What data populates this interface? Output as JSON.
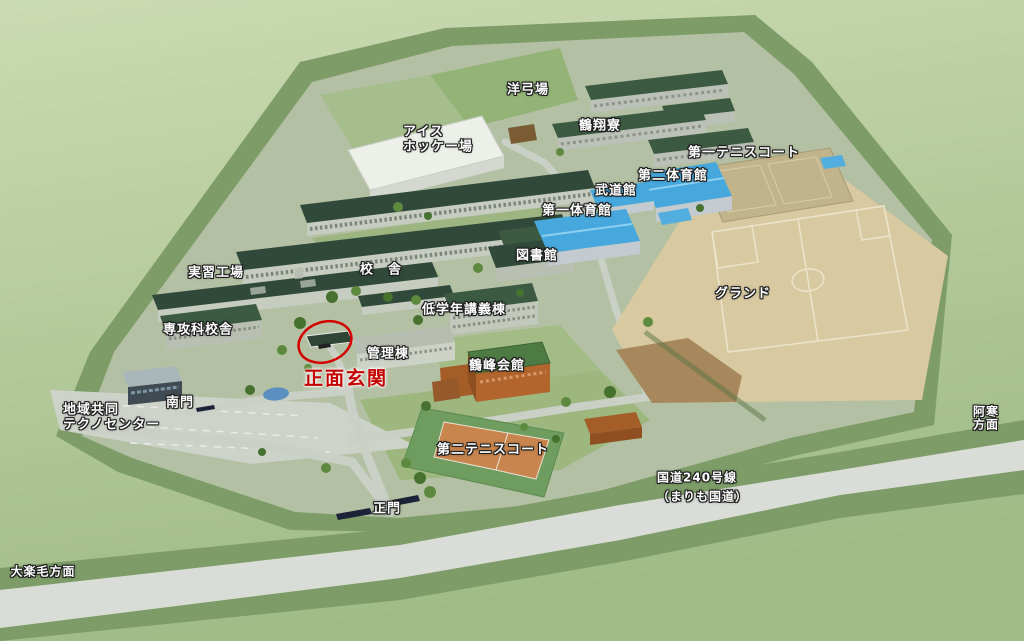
{
  "map": {
    "labels": [
      {
        "id": "youkyujo",
        "text": "洋弓場",
        "x": 528,
        "y": 91
      },
      {
        "id": "kakushoryo",
        "text": "鶴翔寮",
        "x": 600,
        "y": 127
      },
      {
        "id": "ice-hockey-rink",
        "text": "アイス\nホッケー場",
        "x": 403,
        "y": 140,
        "anchor": "left"
      },
      {
        "id": "tennis-court-1",
        "text": "第一テニスコート",
        "x": 744,
        "y": 154
      },
      {
        "id": "gym-2",
        "text": "第二体育館",
        "x": 673,
        "y": 177
      },
      {
        "id": "budokan",
        "text": "武道館",
        "x": 616,
        "y": 192
      },
      {
        "id": "gym-1",
        "text": "第一体育館",
        "x": 577,
        "y": 212
      },
      {
        "id": "library",
        "text": "図書館",
        "x": 537,
        "y": 257
      },
      {
        "id": "school-building",
        "text": "校　舎",
        "x": 381,
        "y": 271
      },
      {
        "id": "practice-factory",
        "text": "実習工場",
        "x": 216,
        "y": 274
      },
      {
        "id": "lower-grade-lecture",
        "text": "低学年講義棟",
        "x": 464,
        "y": 311
      },
      {
        "id": "ground",
        "text": "グランド",
        "x": 743,
        "y": 295
      },
      {
        "id": "advanced-course-bldg",
        "text": "専攻科校舎",
        "x": 198,
        "y": 331
      },
      {
        "id": "admin-building",
        "text": "管理棟",
        "x": 388,
        "y": 355
      },
      {
        "id": "main-entrance",
        "text": "正面玄関",
        "x": 346,
        "y": 379,
        "variant": "entrance"
      },
      {
        "id": "kakuho-kaikan",
        "text": "鶴峰会館",
        "x": 497,
        "y": 367
      },
      {
        "id": "techno-center",
        "text": "地域共同\nテクノセンター",
        "x": 63,
        "y": 418,
        "anchor": "left"
      },
      {
        "id": "south-gate",
        "text": "南門",
        "x": 180,
        "y": 404
      },
      {
        "id": "tennis-court-2",
        "text": "第二テニスコート",
        "x": 493,
        "y": 451
      },
      {
        "id": "main-gate",
        "text": "正門",
        "x": 387,
        "y": 510
      },
      {
        "id": "route-240",
        "text": "国道240号線\n（まりも国道）",
        "x": 657,
        "y": 487,
        "anchor": "left",
        "variant": "road"
      },
      {
        "id": "akan-direction",
        "text": "阿寒方面",
        "x": 986,
        "y": 419,
        "variant": "direction"
      },
      {
        "id": "otanoshike-direction",
        "text": "大楽毛方面",
        "x": 43,
        "y": 572,
        "variant": "direction"
      }
    ],
    "entrance_marker": {
      "x": 325,
      "y": 342,
      "rx": 27,
      "ry": 20,
      "rotation": -18,
      "color": "#d40000"
    },
    "colors": {
      "label_text": "#ffffff",
      "label_outline": "#1c1c1c",
      "entrance_red": "#c40000",
      "outer_terrain": "#b7cc9c",
      "campus_ground": "#b3c0a3",
      "perimeter_band": "#7d9c68",
      "highway": "#d9dcd7",
      "ground_sand": "#d8c9a1",
      "gym_roof_blue": "#46a8dc",
      "roof_dark_green": "#31493a",
      "tennis_court_orange": "#c8854e",
      "kaikan_brown": "#b2652c"
    }
  }
}
